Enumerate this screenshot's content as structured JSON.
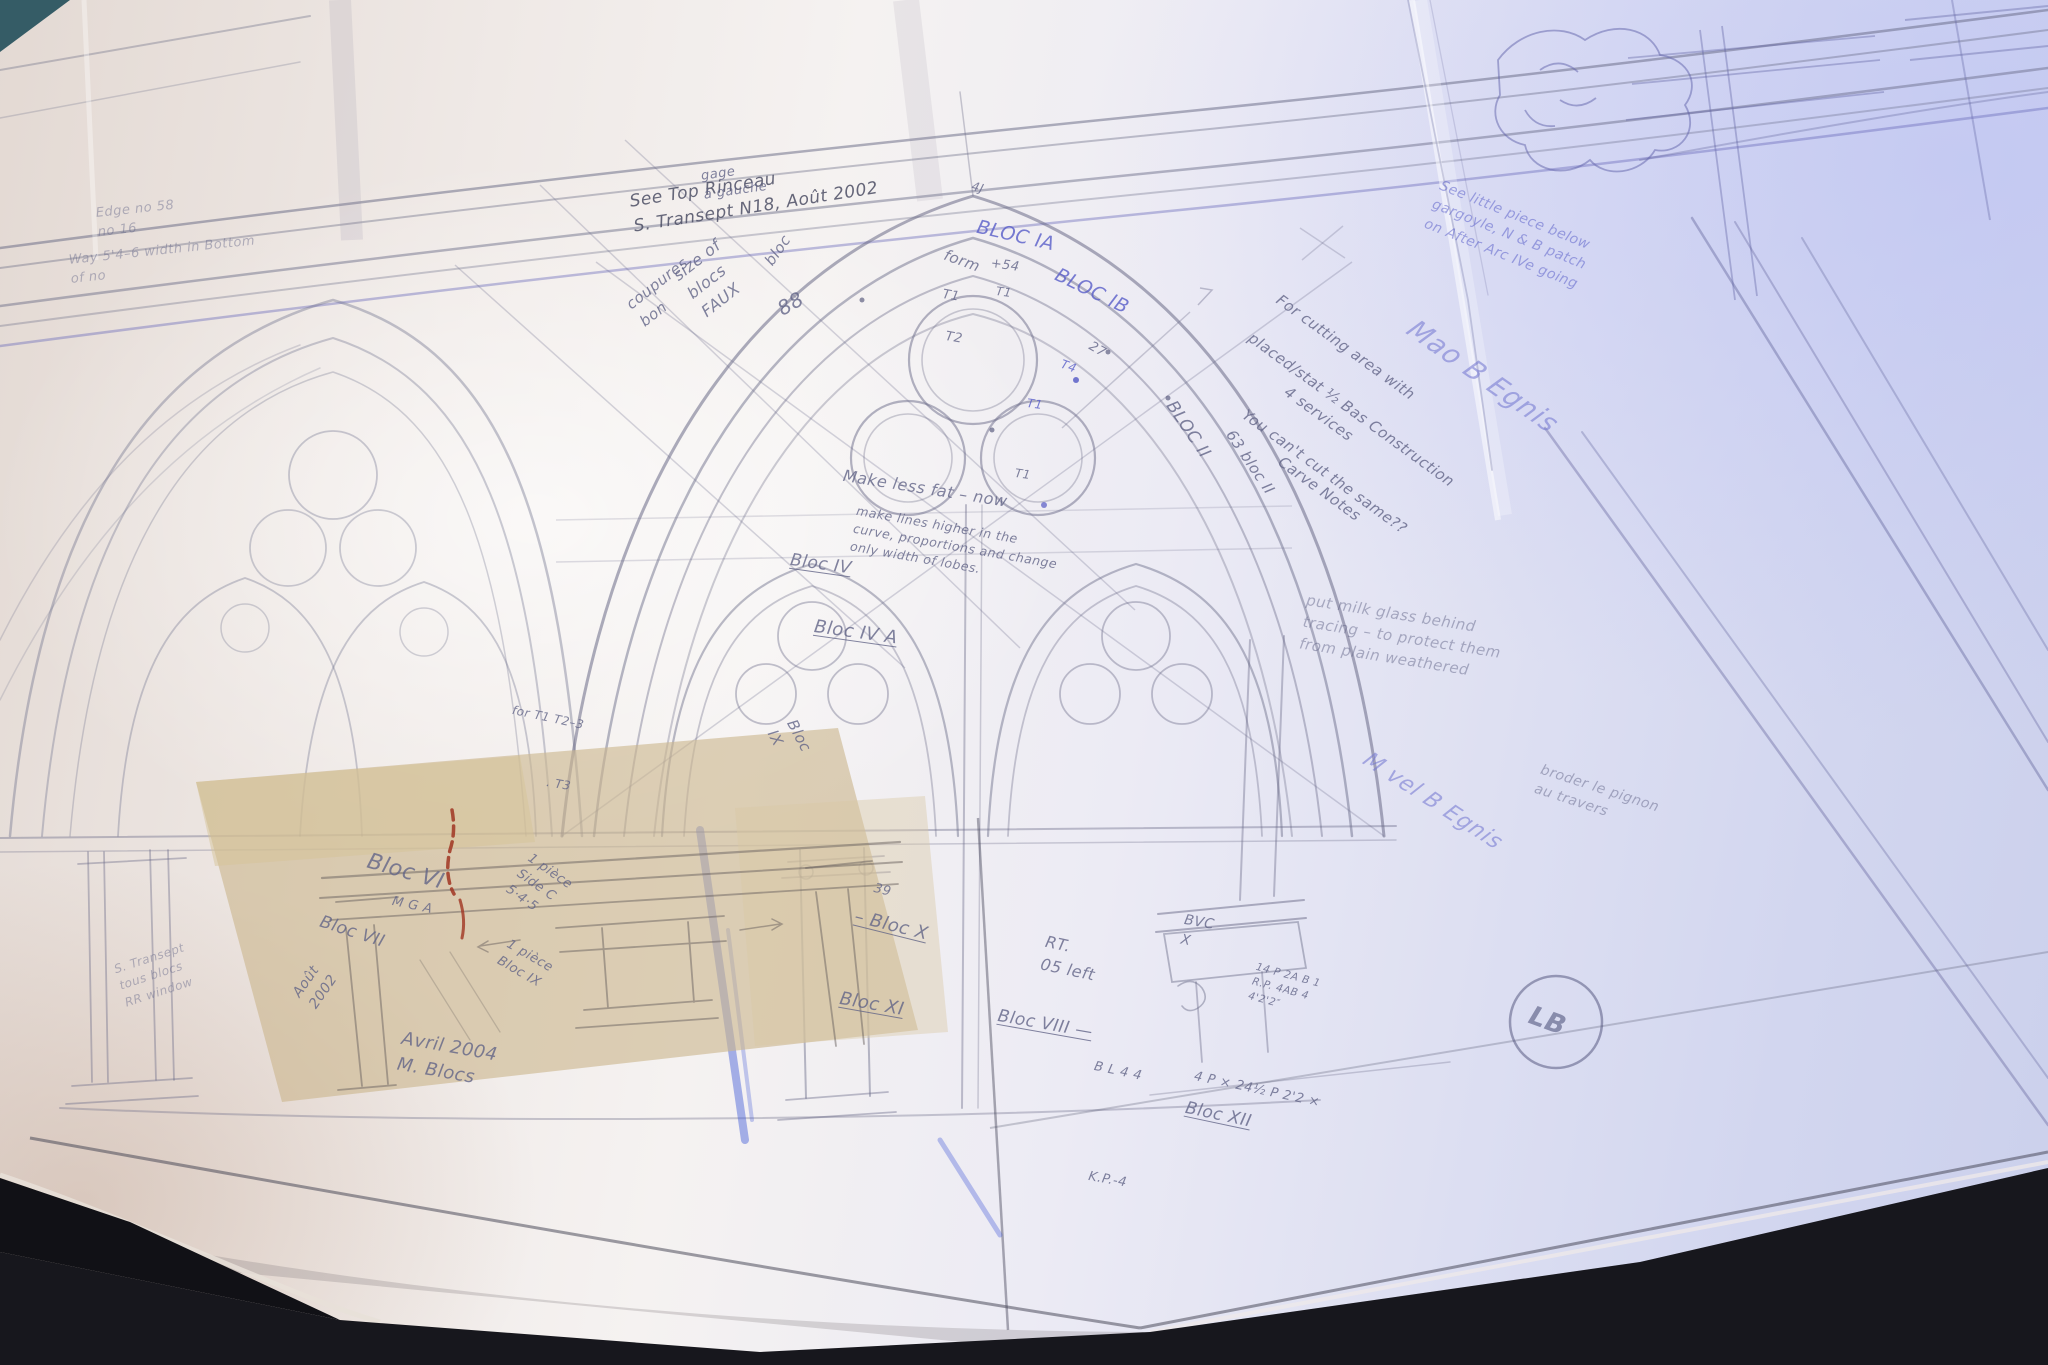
{
  "scene_labels": {
    "drawing_type": "Gothic window tracery elevation, pencil on tracing paper"
  },
  "colors": {
    "paper_warm": "#e9ddd4",
    "paper_cool": "#ccd2ee",
    "graphite": "#6c6c8c",
    "blue_pen": "#5a5fc8",
    "red_mark": "#a03522",
    "tape_patch": "#cbb795",
    "table_dark": "#17171d"
  },
  "annotations": [
    {
      "id": "edge-note-1",
      "text": "Edge no 58\nno 16"
    },
    {
      "id": "edge-note-2",
      "text": "Way 5'4–6 width in Bottom\nof no"
    },
    {
      "id": "rinceau-note",
      "text": "See Top Rinceau\nS. Transept N18,   Août 2002"
    },
    {
      "id": "gage-note",
      "text": "gage\nà gauche"
    },
    {
      "id": "size-note",
      "text": "size of\nblocs\nFAUX"
    },
    {
      "id": "coupures-note",
      "text": "coupures\nbon"
    },
    {
      "id": "bloc-small",
      "text": "bloc"
    },
    {
      "id": "num-88",
      "text": "88"
    },
    {
      "id": "bloc-ia",
      "text": "BLOC IA"
    },
    {
      "id": "bloc-ib",
      "text": "BLOC IB"
    },
    {
      "id": "form-label",
      "text": "form"
    },
    {
      "id": "t1-a",
      "text": "T1"
    },
    {
      "id": "t2-a",
      "text": "T2"
    },
    {
      "id": "plus-54",
      "text": "+54"
    },
    {
      "id": "t1-b",
      "text": "T1"
    },
    {
      "id": "t1-c",
      "text": "T1"
    },
    {
      "id": "t1-d",
      "text": "T1"
    },
    {
      "id": "t4-blue",
      "text": "T4"
    },
    {
      "id": "num-27",
      "text": "27"
    },
    {
      "id": "num-4j",
      "text": "4J"
    },
    {
      "id": "bloc-ii",
      "text": "BLOC II"
    },
    {
      "id": "bloc-63",
      "text": "63 bloc II"
    },
    {
      "id": "cutting-1",
      "text": "For cutting area with"
    },
    {
      "id": "cutting-2",
      "text": "placed/stat ½ Bas Construction"
    },
    {
      "id": "cutting-3",
      "text": "4 services"
    },
    {
      "id": "cutting-4",
      "text": "You can't cut the same??"
    },
    {
      "id": "cutting-5",
      "text": "Carve Notes"
    },
    {
      "id": "signature-1",
      "text": "Mao B Egnis"
    },
    {
      "id": "top-right-note",
      "text": "See little piece below\ngargoyle, N & B patch\non After Arc IVe going"
    },
    {
      "id": "make-less-fat",
      "text": "Make less fat – now"
    },
    {
      "id": "make-lines",
      "text": "make lines higher in the\ncurve, proportions and change\nonly width of lobes."
    },
    {
      "id": "bloc-iv",
      "text": "Bloc IV"
    },
    {
      "id": "bloc-iv-a",
      "text": "Bloc IV A"
    },
    {
      "id": "bloc-ix-steep",
      "text": "Bloc\nIX"
    },
    {
      "id": "for-t123",
      "text": "for T1 T2–3"
    },
    {
      "id": "t3-dot",
      "text": ". T3"
    },
    {
      "id": "mga",
      "text": "M G A"
    },
    {
      "id": "bloc-vi",
      "text": "Bloc VI"
    },
    {
      "id": "bloc-vii",
      "text": "Bloc VII"
    },
    {
      "id": "piece-side-c",
      "text": "1 pièce\nSide C\n5·4·5"
    },
    {
      "id": "piece-bloc-ix",
      "text": "1 pièce\nBloc IX"
    },
    {
      "id": "aout-2002",
      "text": "Août\n2002"
    },
    {
      "id": "avril-2004",
      "text": "Avril 2004\nM. Blocs"
    },
    {
      "id": "num-39",
      "text": "39"
    },
    {
      "id": "bloc-x",
      "text": "– Bloc X"
    },
    {
      "id": "rt-05-left",
      "text": "RT.\n05 left"
    },
    {
      "id": "bloc-xi",
      "text": "Bloc XI"
    },
    {
      "id": "bloc-viii",
      "text": "Bloc VIII —"
    },
    {
      "id": "bvc-x",
      "text": "BVC\nX"
    },
    {
      "id": "rp-note",
      "text": "14 P 2A B 1\nR.P. 4AB 4\n4'2'2″"
    },
    {
      "id": "bl-44",
      "text": "B L 4 4"
    },
    {
      "id": "dim-note",
      "text": "4 P × 24½  P 2'2 ×"
    },
    {
      "id": "bloc-xii",
      "text": "Bloc XII"
    },
    {
      "id": "kp-4",
      "text": "K.P.-4"
    },
    {
      "id": "milk-glass-note",
      "text": "put milk glass behind\ntracing – to protect them\nfrom plain weathered"
    },
    {
      "id": "signature-2",
      "text": "M vel B Egnis"
    },
    {
      "id": "broder-note",
      "text": "broder le pignon\nau travers"
    },
    {
      "id": "transept-scrawl",
      "text": "S. Transept\ntous blocs\nRR window"
    },
    {
      "id": "stamp-monogram",
      "text": "LB"
    }
  ]
}
